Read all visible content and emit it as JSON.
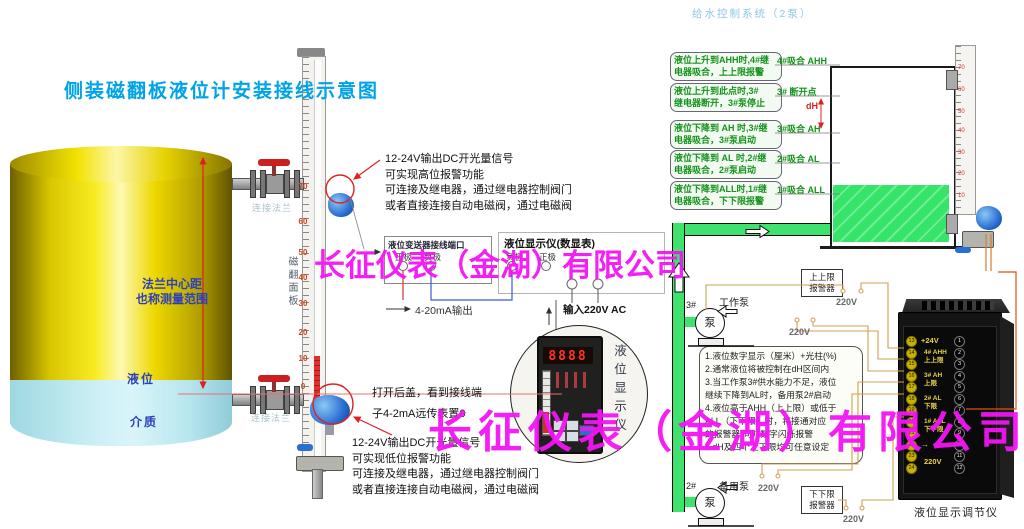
{
  "title": "侧装磁翻板液位计安装接线示意图",
  "system_title": "给水控制系统（2泵）",
  "watermark": "长征仪表（金湖）有限公司",
  "colors": {
    "watermark": "#f414f4",
    "title_blue": "#00a3e8",
    "pipe_green": "#3fe26d",
    "logic_green": "#13931c",
    "alarm_red": "#e02020",
    "wire_tan": "#cfa050"
  },
  "tank": {
    "range_label": "法兰中心距\n也称测量范围",
    "level_label": "液位",
    "medium_label": "介质"
  },
  "gauge_left": {
    "panel_label": "磁翻面板",
    "flange_top": "连接法兰",
    "flange_bottom": "连接法兰",
    "scale": [
      "70",
      "60",
      "50",
      "40",
      "30",
      "20",
      "10",
      "0"
    ]
  },
  "gauge_right": {
    "scale": [
      "70",
      "60",
      "50",
      "40",
      "30",
      "20",
      "10"
    ]
  },
  "alarm_note_high": "12-24V输出DC开光量信号\n可实现高位报警功能\n可连接及继电器，通过继电器控制阀门\n或者直接连接自动电磁阀，通过电磁阀",
  "alarm_note_low": "12-24V输出DC开光量信号\n可实现低位报警功能\n可连接及继电器，通过继电器控制阀门\n或者直接连接自动电磁阀，通过电磁阀",
  "open_cover_note": "打开后盖，看到接线端\n子4-2mA远传表置0",
  "transmitter": {
    "title": "液位变送器接线端口",
    "pos": "正极",
    "neg": "负极"
  },
  "display": {
    "title": "液位显示仪(数显表)",
    "neg": "负极",
    "pos": "正极",
    "output": "4-20mA输出",
    "input": "输入220V AC",
    "photo_label": "液位显示仪",
    "readout": "8888"
  },
  "logic": [
    {
      "text": "液位上升到AHH时,4#继\n电器吸合，上上限报警",
      "tag": "4#吸合 AHH"
    },
    {
      "text": "液位上升到此点时,3#\n继电器断开，3#泵停止",
      "tag": "3# 断开点"
    },
    {
      "text": "液位下降到 AH 时,3#继\n电器吸合，3#泵启动",
      "tag": "3#吸合 AH"
    },
    {
      "text": "液位下降到 AL 时,2#继\n电器吸合，2#泵启动",
      "tag": "2#吸合 AL"
    },
    {
      "text": "液位下降到ALL时,1#继\n电器吸合，下下限报警",
      "tag": "1#吸合 ALL"
    }
  ],
  "dh": "dH",
  "piping": {
    "pump_work_num": "3#",
    "pump_work_name": "工作泵",
    "pump_backup_num": "2#",
    "pump_backup_name": "备用泵",
    "pump_symbol": "泵",
    "v220": "220V",
    "alarm_high": "上上限\n报警器",
    "alarm_low": "下下限\n报警器"
  },
  "controller": {
    "caption": "液位显示调节仪",
    "left_terminals": [
      "13",
      "14",
      "15",
      "16",
      "17",
      "18",
      "19",
      "20",
      "21",
      "22",
      "23",
      "24"
    ],
    "right_terminals": [
      "1",
      "2",
      "3",
      "4",
      "5",
      "6",
      "7",
      "8",
      "9",
      "10",
      "11",
      "12"
    ],
    "lbl_24v": "+24V",
    "lbl_ahh": "4# AHH\n上上限",
    "lbl_ah": "3# AH\n上限",
    "lbl_al": "2# AL\n下限",
    "lbl_all": "1# ALL\n下下限",
    "lbl_gnd": "→",
    "lbl_220": "220V"
  },
  "spec_notes": "1.液位数字显示（厘米）+光柱(%)\n2.通常液位将被控制在dH区间内\n3.当工作泵3#供水能力不足，液位\n  继续下降到AL时，备用泵2#启动\n4.液位高于AHH（上上限）或低于\n  ALL（下下限）时，将接通对应\n  的报警器 同时数字闪烁报警\n5.dH及四个上下限均可任意设定"
}
